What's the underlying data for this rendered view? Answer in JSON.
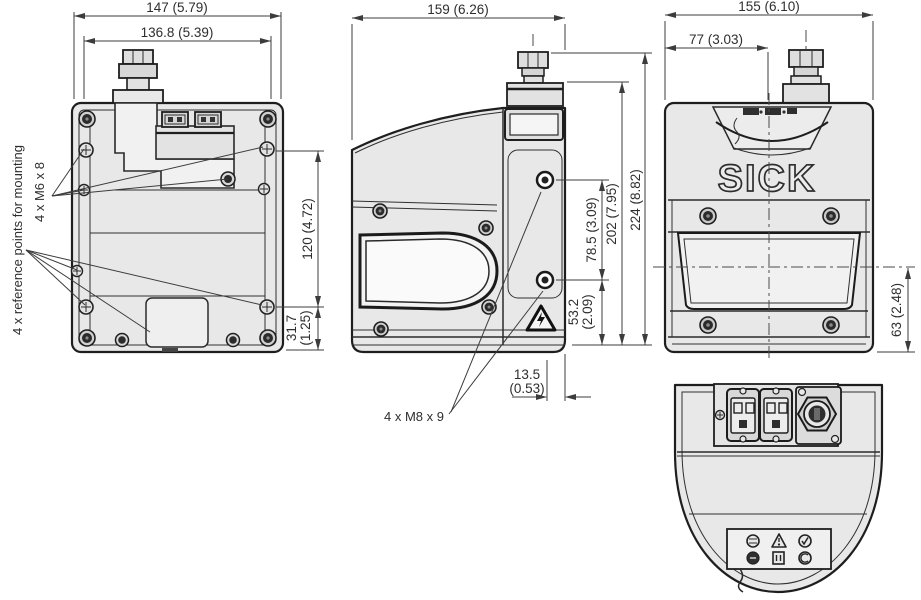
{
  "annotations": {
    "reference_points": "4 x reference points for mounting",
    "m6": "4 x M6 x 8",
    "m8": "4 x M8 x 9"
  },
  "logo": "SICK",
  "back_view": {
    "width_outer": "147 (5.79)",
    "width_inner": "136.8 (5.39)",
    "height_upper": "120 (4.72)",
    "height_lower_mm": "31.7",
    "height_lower_in": "(1.25)"
  },
  "side_view": {
    "width": "159 (6.26)",
    "height_total": "224 (8.82)",
    "height_body": "202 (7.95)",
    "hole_spacing": "78.5 (3.09)",
    "hole_to_bottom_mm": "53.2",
    "hole_to_bottom_in": "(2.09)",
    "depth_offset_mm": "13.5",
    "depth_offset_in": "(0.53)"
  },
  "front_view": {
    "width": "155 (6.10)",
    "center_offset": "77 (3.03)",
    "scan_plane_height": "63 (2.48)"
  }
}
